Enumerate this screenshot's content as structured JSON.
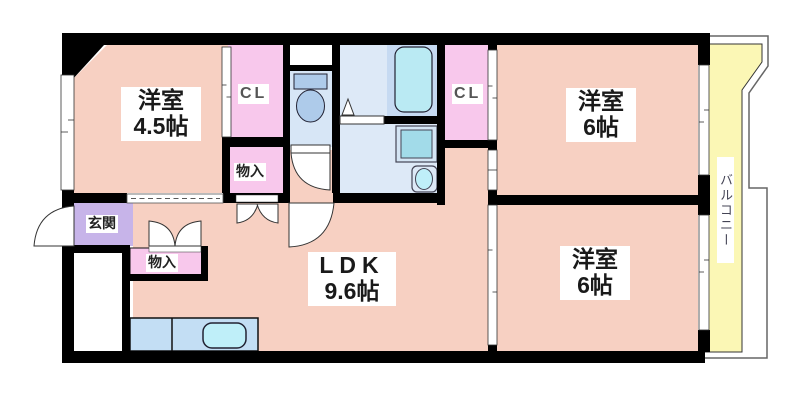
{
  "floorplan": {
    "type": "apartment-floor-plan",
    "rooms": {
      "western_room_1": {
        "name": "洋室",
        "size": "4.5帖"
      },
      "western_room_2": {
        "name": "洋室",
        "size": "6帖"
      },
      "western_room_3": {
        "name": "洋室",
        "size": "6帖"
      },
      "ldk": {
        "name": "LDK",
        "size": "9.6帖"
      },
      "entrance": {
        "name": "玄関"
      },
      "closet_1": {
        "name": "CL"
      },
      "closet_2": {
        "name": "CL"
      },
      "storage_1": {
        "name": "物入"
      },
      "storage_2": {
        "name": "物入"
      },
      "balcony": {
        "name": "バルコニー"
      }
    },
    "fixtures": [
      "toilet-icon",
      "bathtub-icon",
      "washing-machine-icon",
      "washbasin-icon",
      "kitchen-sink-icon"
    ],
    "colors": {
      "room_floor": "#F7D0C2",
      "closet": "#F8C8EC",
      "entrance": "#C7B4E9",
      "wet_floor": "#DDE9F7",
      "toilet_floor": "#D7E6F6",
      "bath_surround": "#C6DAF2",
      "bathtub": "#BAEAF3",
      "appliance": "#A2DBE9",
      "fixture_blue": "#AECBEA",
      "washer_box": "#D4E5F4",
      "kitchen_counter": "#C3DEF4",
      "sink_cyan": "#BFEFF9",
      "balcony_floor": "#FBF7B5",
      "wall": "#000000",
      "white": "#FFFFFF"
    }
  }
}
